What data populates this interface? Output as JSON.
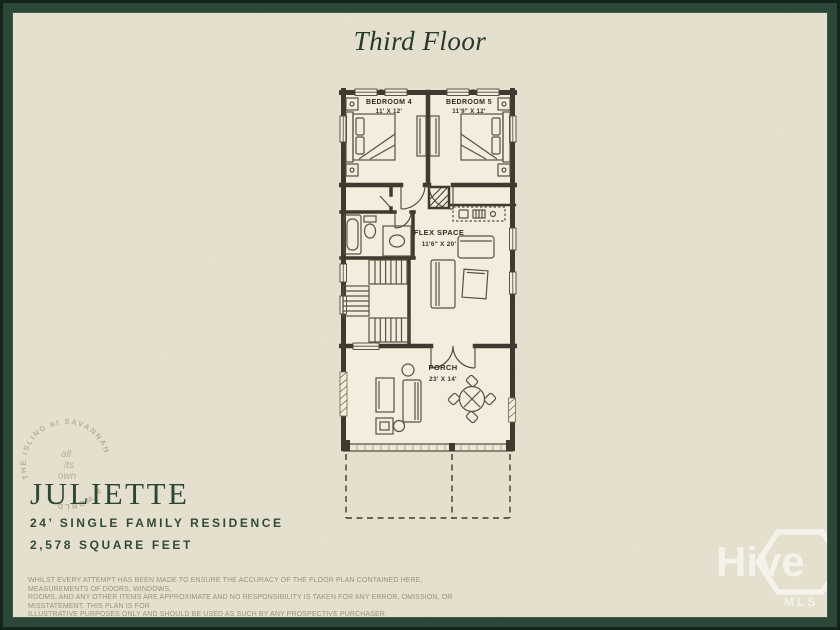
{
  "frame": {
    "title": "Third Floor"
  },
  "floor_plan": {
    "rooms": [
      {
        "name": "BEDROOM 4",
        "dims": "11' X 12'"
      },
      {
        "name": "BEDROOM 5",
        "dims": "11'9\" X 12'"
      },
      {
        "name": "FLEX SPACE",
        "dims": "11'6\" X 20'"
      },
      {
        "name": "PORCH",
        "dims": "23' X 14'"
      }
    ]
  },
  "stamp": {
    "arc_text": "THE ISLING at SAVANNAH",
    "arc_text_2": "A WORLD",
    "center_line_1": "all",
    "center_line_2": "its",
    "center_line_3": "own"
  },
  "plan_info": {
    "name": "JULIETTE",
    "type": "24’ SINGLE FAMILY RESIDENCE",
    "area": "2,578 SQUARE FEET"
  },
  "disclaimer": {
    "line1": "WHILST EVERY ATTEMPT HAS BEEN MADE TO ENSURE THE ACCURACY OF THE FLOOR PLAN CONTAINED HERE, MEASUREMENTS OF DOORS, WINDOWS,",
    "line2": "ROOMS, AND ANY OTHER ITEMS ARE APPROXIMATE AND NO RESPONSIBILITY IS TAKEN FOR ANY ERROR, OMISSION, OR MISSTATEMENT. THIS PLAN IS FOR",
    "line3": "ILLUSTRATIVE PURPOSES ONLY AND SHOULD BE USED AS SUCH BY ANY PROSPECTIVE PURCHASER."
  },
  "watermark": {
    "brand": "Hive",
    "sub": "MLS"
  },
  "colors": {
    "border_green": "#2b4737",
    "border_dark": "#14241a",
    "background": "#e6e1ce",
    "paper": "#f2eddc",
    "ink": "#3e3a2f",
    "accent": "#2d4737",
    "disclaimer_text": "#9b9278"
  }
}
